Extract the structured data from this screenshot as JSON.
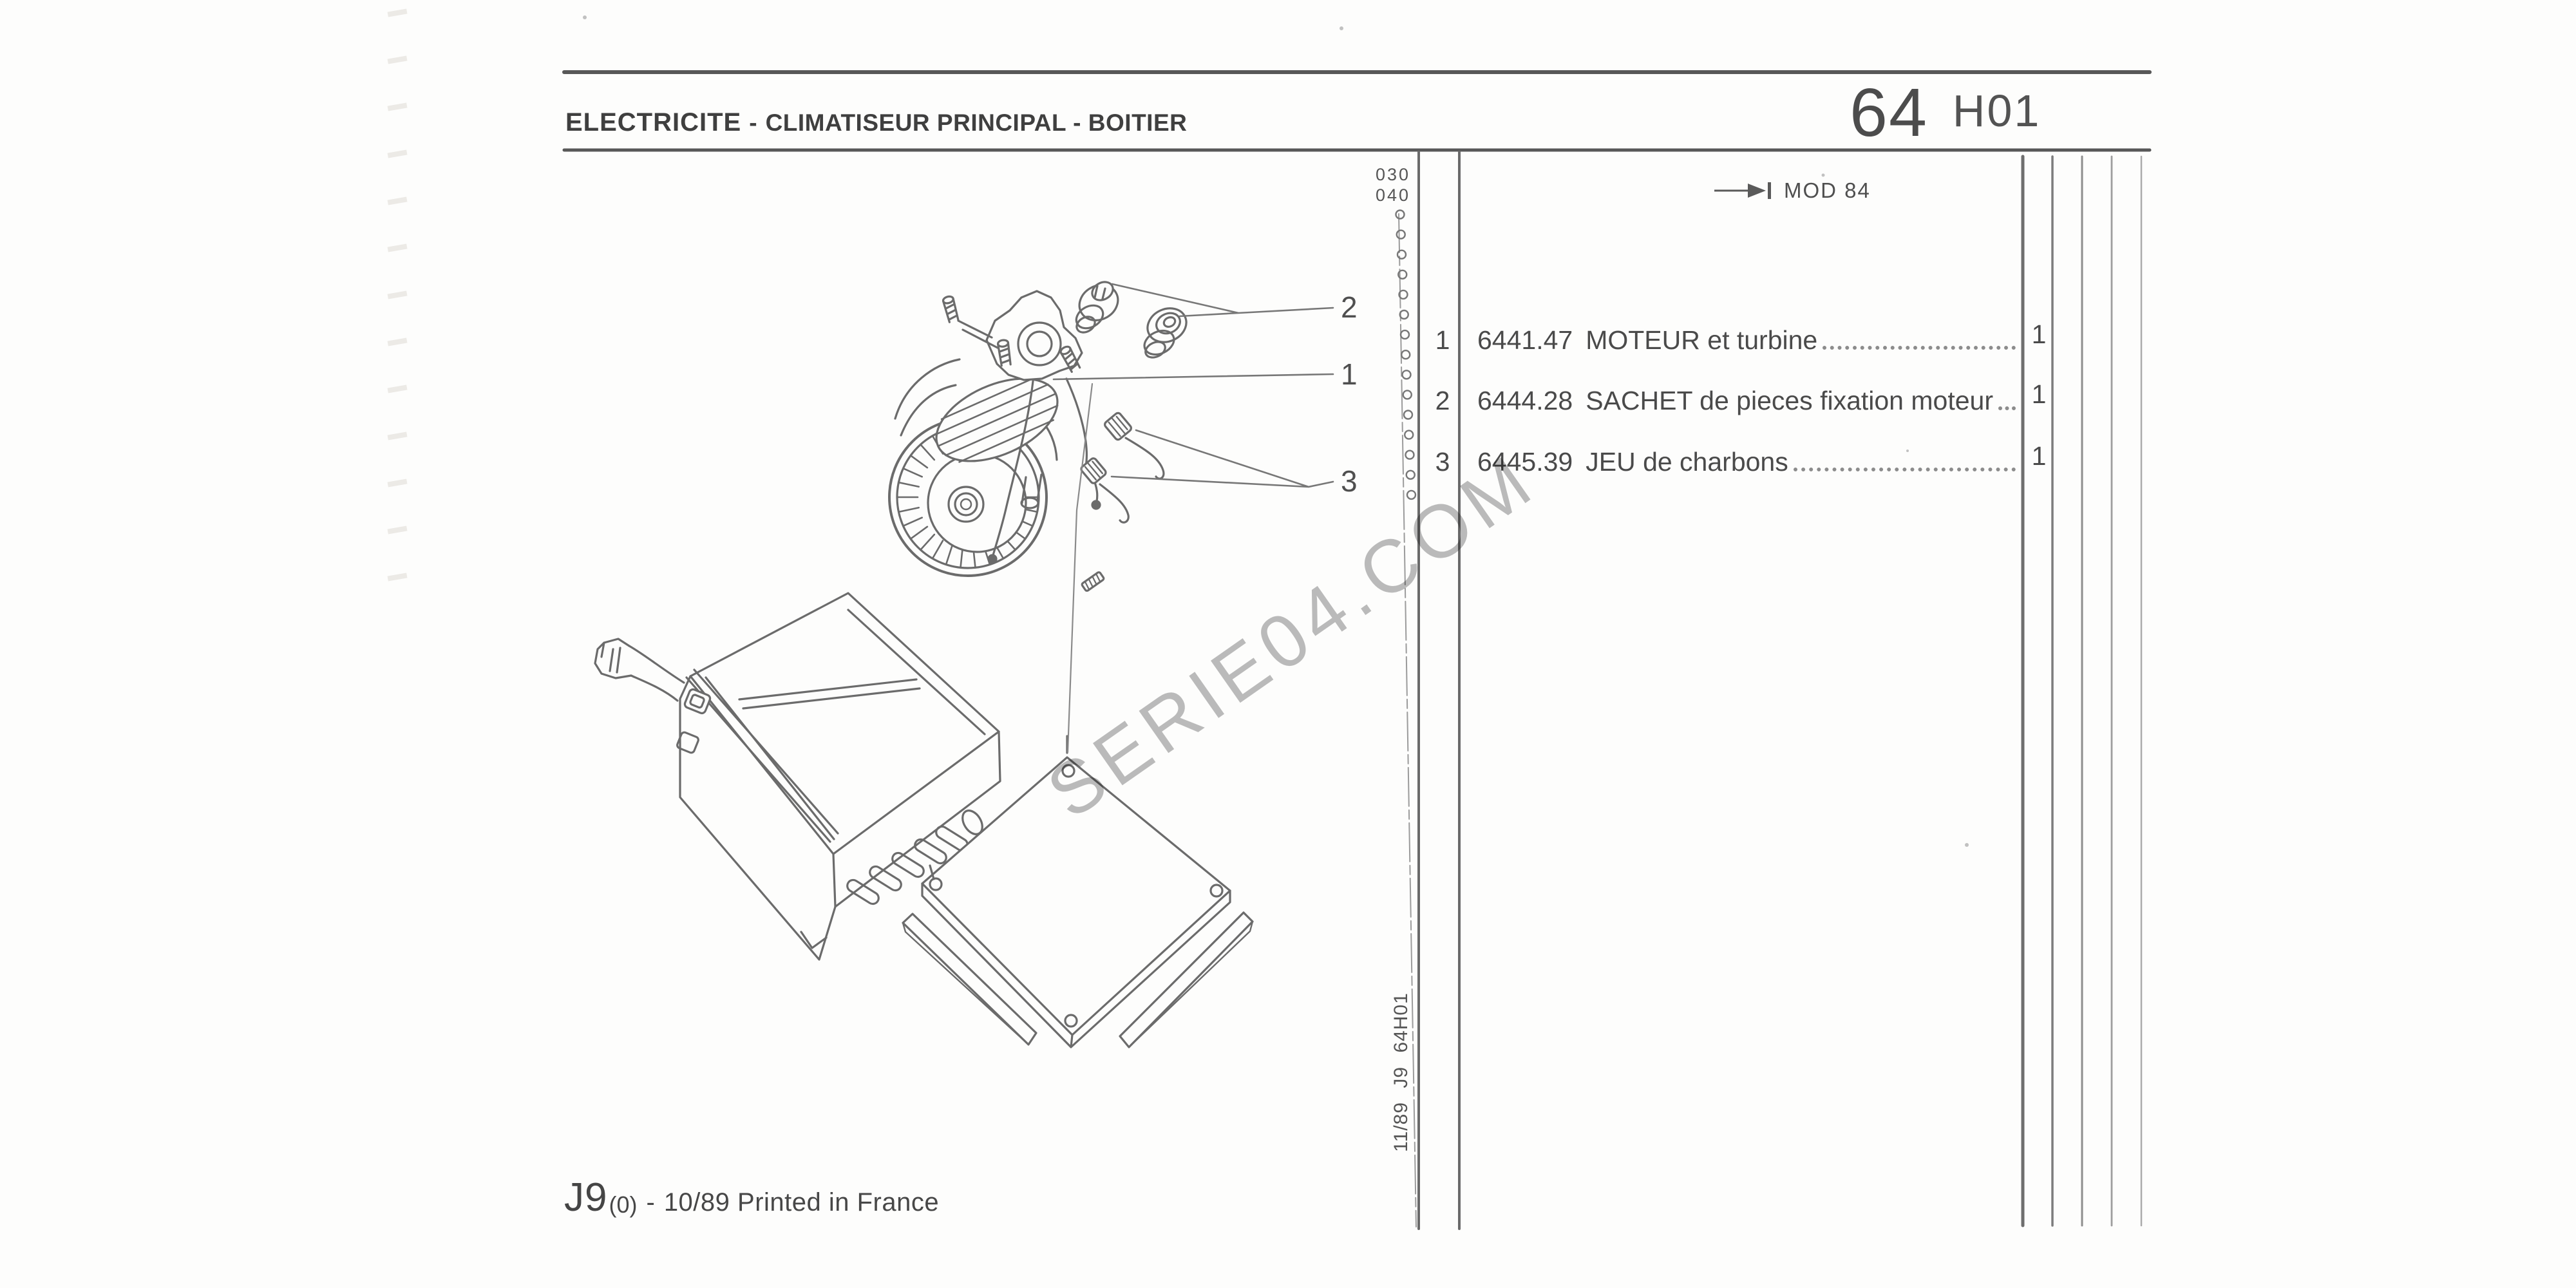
{
  "header": {
    "section_title": "ELECTRICITE",
    "separator": "-",
    "section_subtitle": "CLIMATISEUR PRINCIPAL - BOITIER",
    "page_number": "64",
    "page_code": "H01"
  },
  "margin_column": {
    "revision_codes": [
      "030",
      "040"
    ],
    "spine_text": "11/89 J9 64H01"
  },
  "mod_note": {
    "label": "MOD 84"
  },
  "parts_table": {
    "rows": [
      {
        "ref": "1",
        "code": "6441.47",
        "label": "MOTEUR et turbine",
        "qty": "1"
      },
      {
        "ref": "2",
        "code": "6444.28",
        "label": "SACHET de pieces fixation moteur",
        "qty": "1"
      },
      {
        "ref": "3",
        "code": "6445.39",
        "label": "JEU de charbons",
        "qty": "1"
      }
    ]
  },
  "diagram": {
    "callouts": [
      {
        "label": "1"
      },
      {
        "label": "2"
      },
      {
        "label": "3"
      }
    ]
  },
  "watermark": "SERIE04.COM",
  "footer": {
    "model": "J9",
    "variant": "(0)",
    "separator": "-",
    "printed_note": "10/89 Printed in France"
  },
  "colors": {
    "paper": "#fdfdfc",
    "ink": "#474747",
    "line": "#6b6b6b",
    "watermark": "#bcbcbc"
  }
}
